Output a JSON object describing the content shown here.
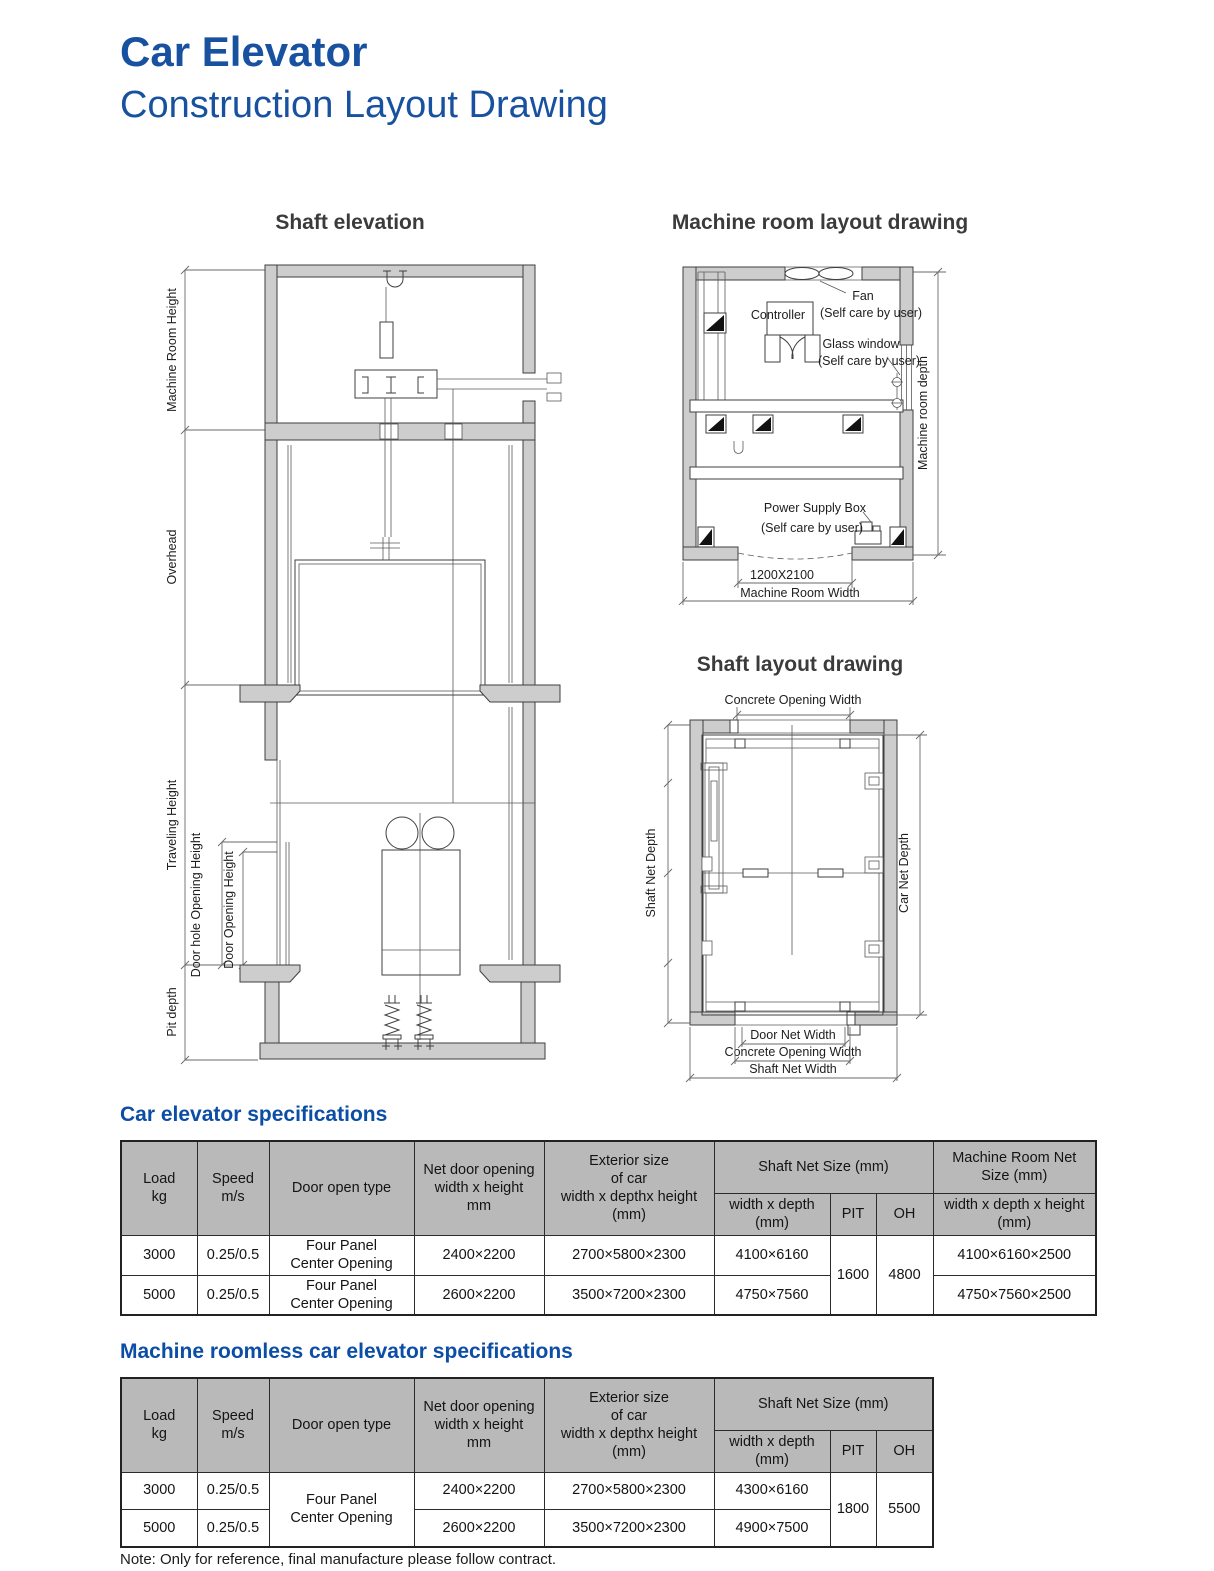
{
  "page": {
    "title1": "Car Elevator",
    "title2": "Construction Layout Drawing",
    "note": "Note: Only for reference, final manufacture please follow contract.",
    "accent_color": "#17519f"
  },
  "shaft_elevation": {
    "title": "Shaft elevation",
    "dim_machine_room_height": "Machine Room Height",
    "dim_overhead": "Overhead",
    "dim_traveling_height": "Traveling Height",
    "dim_door_hole": "Door hole Opening Height",
    "dim_door_opening": "Door Opening Height",
    "dim_pit_depth": "Pit depth"
  },
  "machine_room": {
    "title": "Machine room layout drawing",
    "fan": "Fan",
    "fan_note": "(Self care by user)",
    "controller": "Controller",
    "glass": "Glass window",
    "glass_note": "(Self care by user)",
    "power": "Power Supply Box",
    "power_note": "(Self care by user)",
    "door_size": "1200X2100",
    "width": "Machine Room Width",
    "depth": "Machine room depth"
  },
  "shaft_layout": {
    "title": "Shaft layout drawing",
    "top_width": "Concrete Opening Width",
    "shaft_net_depth": "Shaft Net Depth",
    "car_net_depth": "Car Net Depth",
    "door_net_width": "Door Net Width",
    "concrete_opening_width": "Concrete Opening Width",
    "shaft_net_width": "Shaft Net Width"
  },
  "spec_table": {
    "heading": "Car elevator specifications",
    "headers": {
      "load": "Load\nkg",
      "speed": "Speed\nm/s",
      "door": "Door open type",
      "net_door": "Net door opening\nwidth x height\nmm",
      "exterior": "Exterior size\nof car\nwidth x depthx height\n(mm)",
      "shaft_group": "Shaft Net Size (mm)",
      "shaft_wd": "width x depth\n(mm)",
      "pit": "PIT",
      "oh": "OH",
      "mr_group": "Machine Room Net\nSize (mm)",
      "mr_wdh": "width x depth x height\n(mm)"
    },
    "rows": [
      {
        "load": "3000",
        "speed": "0.25/0.5",
        "door": "Four Panel\nCenter Opening",
        "net_door": "2400×2200",
        "exterior": "2700×5800×2300",
        "shaft_wd": "4100×6160",
        "mr": "4100×6160×2500"
      },
      {
        "load": "5000",
        "speed": "0.25/0.5",
        "door": "Four Panel\nCenter Opening",
        "net_door": "2600×2200",
        "exterior": "3500×7200×2300",
        "shaft_wd": "4750×7560",
        "mr": "4750×7560×2500"
      }
    ],
    "pit_value": "1600",
    "oh_value": "4800"
  },
  "roomless_table": {
    "heading": "Machine roomless car elevator specifications",
    "headers": {
      "load": "Load\nkg",
      "speed": "Speed\nm/s",
      "door": "Door open type",
      "net_door": "Net door opening\nwidth x height\nmm",
      "exterior": "Exterior size\nof car\nwidth x depthx height\n(mm)",
      "shaft_group": "Shaft Net Size (mm)",
      "shaft_wd": "width x depth\n(mm)",
      "pit": "PIT",
      "oh": "OH"
    },
    "door_merged": "Four Panel\nCenter Opening",
    "rows": [
      {
        "load": "3000",
        "speed": "0.25/0.5",
        "net_door": "2400×2200",
        "exterior": "2700×5800×2300",
        "shaft_wd": "4300×6160"
      },
      {
        "load": "5000",
        "speed": "0.25/0.5",
        "net_door": "2600×2200",
        "exterior": "3500×7200×2300",
        "shaft_wd": "4900×7500"
      }
    ],
    "pit_value": "1800",
    "oh_value": "5500"
  }
}
